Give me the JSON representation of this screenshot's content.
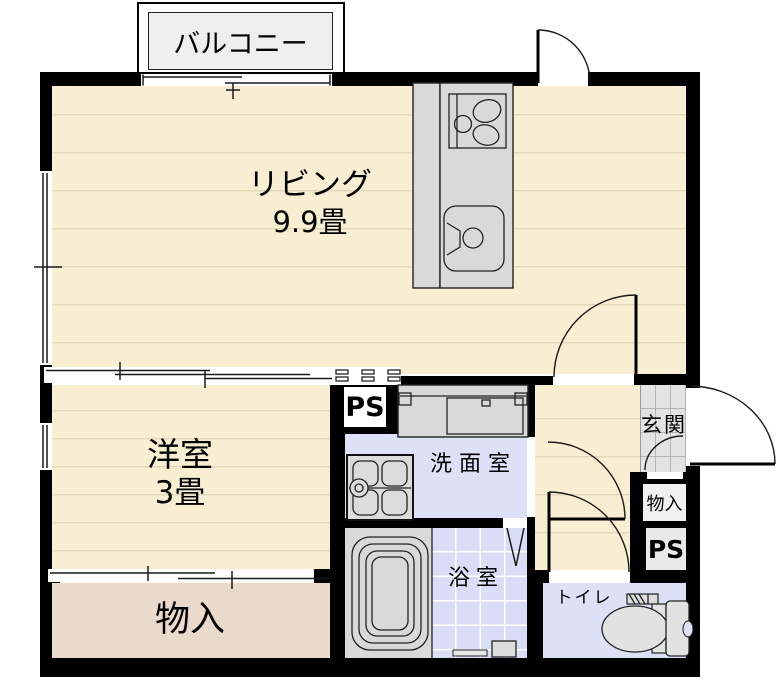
{
  "plan_title": "1K apartment floor plan",
  "rooms": {
    "balcony": {
      "label": "バルコニー"
    },
    "living": {
      "label": "リビング",
      "size": "9.9畳"
    },
    "bedroom": {
      "label": "洋室",
      "size": "3畳"
    },
    "storage_bottom": {
      "label": "物入"
    },
    "washroom": {
      "label": "洗面室"
    },
    "bathroom": {
      "label": "浴室"
    },
    "toilet": {
      "label": "トイレ"
    },
    "entrance": {
      "label": "玄関"
    },
    "storage_right": {
      "label": "物入"
    },
    "pipe_space_left": {
      "label": "PS"
    },
    "pipe_space_right": {
      "label": "PS"
    }
  },
  "fixtures": {
    "stove": "gas-stove-icon",
    "kitchen_sink": "kitchen-sink-icon",
    "vanity": "washbasin-counter-icon",
    "washer_pan": "washing-machine-pan-icon",
    "bathtub": "bathtub-icon",
    "toilet_bowl": "toilet-icon",
    "doors": "door-swing-arc",
    "windows": "sliding-window-symbol"
  },
  "colors": {
    "wall": "#000000",
    "floor_cream": "#f8efd2",
    "tatami_line": "#e3d9ba",
    "floor_pink": "#eadacc",
    "floor_periwinkle": "#dde1f7",
    "bath_tile": "#d9def6",
    "tile_line": "#ffffff",
    "genkan_tile": "#e3e3e3",
    "genkan_line": "#b4b4b4",
    "fixture_gray": "#d9d9d9",
    "box_white": "#ffffff",
    "balcony_fill": "#efefef"
  }
}
